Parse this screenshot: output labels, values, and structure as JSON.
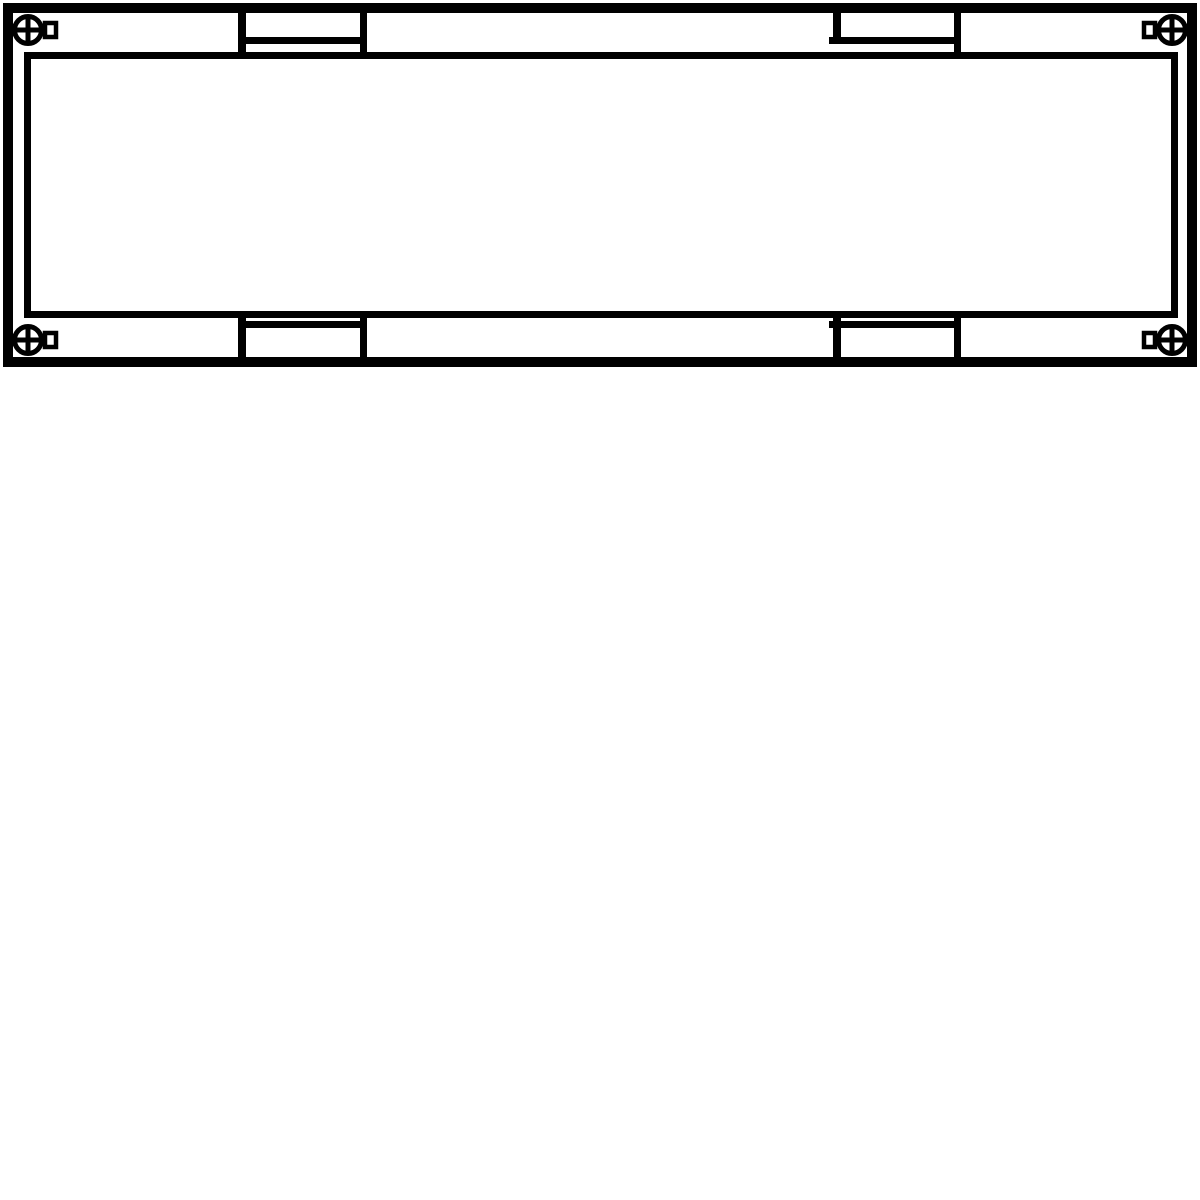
{
  "colors": {
    "line": "#000000",
    "background": "#ffffff"
  },
  "components": {
    "frame": "outer-frame",
    "panel": "inner-panel",
    "screws": [
      "screw-top-left",
      "screw-top-right",
      "screw-bottom-left",
      "screw-bottom-right"
    ],
    "clips": [
      "clip-top-left",
      "clip-top-right",
      "clip-bottom-left",
      "clip-bottom-right"
    ],
    "screw_icon": "phillips-cross-icon",
    "screw_tab_icon": "square-tab-icon"
  }
}
